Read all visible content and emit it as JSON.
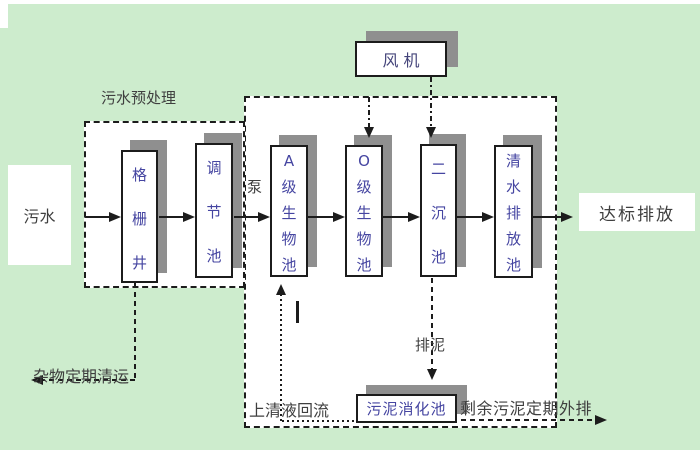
{
  "diagram": {
    "type": "wastewater-treatment-process-flow",
    "colors": {
      "background": "#cdeccd",
      "panel": "#ffffff",
      "box_shadow": "#8f8f8f",
      "line": "#1c1c1c",
      "box_text": "#4545a1",
      "label_text": "#3f3f3f"
    },
    "nodes": {
      "influent": "污水",
      "grid_well": "格栅井",
      "regulating_tank": "调节池",
      "pump": "泵",
      "a_bio_tank": "A级生物池",
      "o_bio_tank": "O级生物池",
      "secondary_sedimentation_tank": "二沉池",
      "clear_water_discharge_tank": "清水排放池",
      "blower": "风 机",
      "sludge_digester": "污泥消化池",
      "effluent": "达标排放"
    },
    "annotations": {
      "pretreatment_group": "污水预处理",
      "debris_removal": "杂物定期清运",
      "supernatant_return": "上清液回流",
      "sludge_discharge": "排泥",
      "excess_sludge_outflow": "剩余污泥定期外排"
    }
  }
}
